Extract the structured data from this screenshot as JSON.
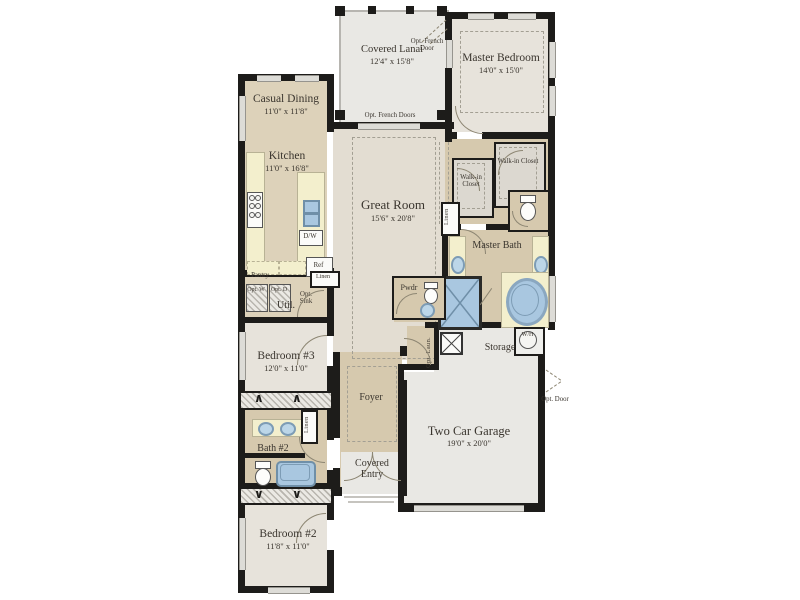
{
  "plan_type": "residential floor plan",
  "rooms": {
    "covered_lanai": {
      "name": "Covered Lanai",
      "dims": "12'4\" x 15'8\""
    },
    "master_bedroom": {
      "name": "Master Bedroom",
      "dims": "14'0\" x 15'0\""
    },
    "casual_dining": {
      "name": "Casual Dining",
      "dims": "11'0\" x 11'8\""
    },
    "kitchen": {
      "name": "Kitchen",
      "dims": "11'0\" x 16'8\""
    },
    "great_room": {
      "name": "Great Room",
      "dims": "15'6\" x 20'8\""
    },
    "walk_in_closet": {
      "name": "Walk-in Closet"
    },
    "master_bath": {
      "name": "Master Bath"
    },
    "pwdr": {
      "name": "Pwdr"
    },
    "util": {
      "name": "Util."
    },
    "bedroom3": {
      "name": "Bedroom #3",
      "dims": "12'0\" x 11'0\""
    },
    "foyer": {
      "name": "Foyer"
    },
    "storage": {
      "name": "Storage"
    },
    "garage": {
      "name": "Two Car Garage",
      "dims": "19'0\" x 20'0\""
    },
    "bath2": {
      "name": "Bath #2"
    },
    "bedroom2": {
      "name": "Bedroom #2",
      "dims": "11'8\" x 11'0\""
    },
    "covered_entry": {
      "name": "Covered Entry"
    }
  },
  "annotations": {
    "opt_french_doors": "Opt. French Doors",
    "opt_french_door": "Opt. French Door",
    "opt_door": "Opt. Door",
    "opt_sink": "Opt. Sink",
    "opt_washer": "Opt. W",
    "opt_dryer": "Opt. D",
    "opt_laundry": "Opt. Laun.",
    "pantry": "Pantry",
    "refrigerator": "Ref",
    "dishwasher": "D/W",
    "water_heater": "W/H",
    "linen": "Linen"
  },
  "icons": {
    "closet_rod_up": "∧",
    "closet_rod_down": "∨"
  },
  "colors": {
    "wall": "#1d1c1a",
    "beige_floor": "#ddd2ba",
    "tan_floor": "#d6c9ae",
    "light_floor": "#e7e3db",
    "gray_floor": "#e9e8e4",
    "great_room_floor": "#e3ddd2",
    "counter": "#f3efcd",
    "fixture_blue": "#a9c7e0"
  }
}
